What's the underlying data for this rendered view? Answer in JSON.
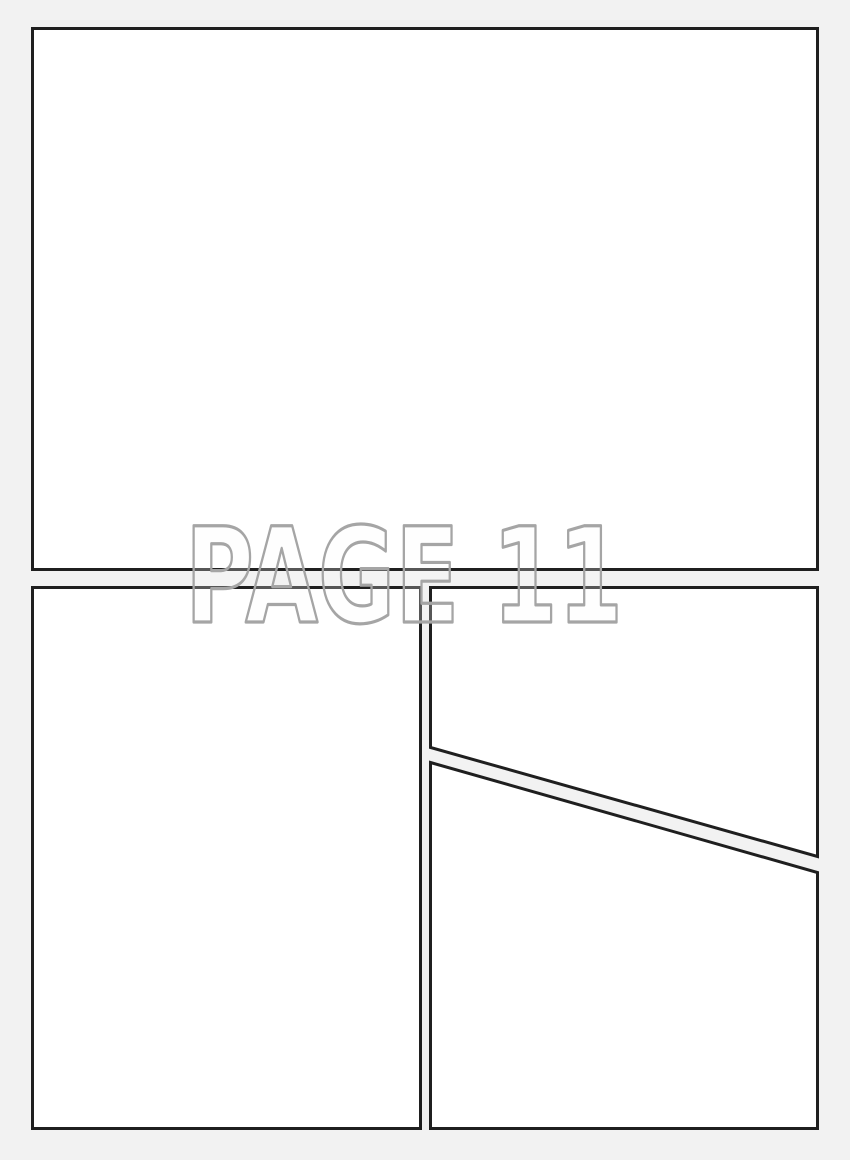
{
  "page": {
    "title": "PAGE 11"
  },
  "colors": {
    "page_background": "#f2f2f2",
    "panel_fill": "#ffffff",
    "panel_border": "#1f1f1f",
    "title_outline": "#a5a5a5",
    "title_fill": "#fcfcfc"
  },
  "panels": [
    {
      "id": "panel-1",
      "row": "top",
      "shape": "rectangle"
    },
    {
      "id": "panel-2",
      "row": "bottom-left",
      "shape": "rectangle"
    },
    {
      "id": "panel-3",
      "row": "bottom-right-upper",
      "shape": "quadrilateral with diagonal bottom edge"
    },
    {
      "id": "panel-4",
      "row": "bottom-right-lower",
      "shape": "quadrilateral with diagonal top edge"
    }
  ]
}
